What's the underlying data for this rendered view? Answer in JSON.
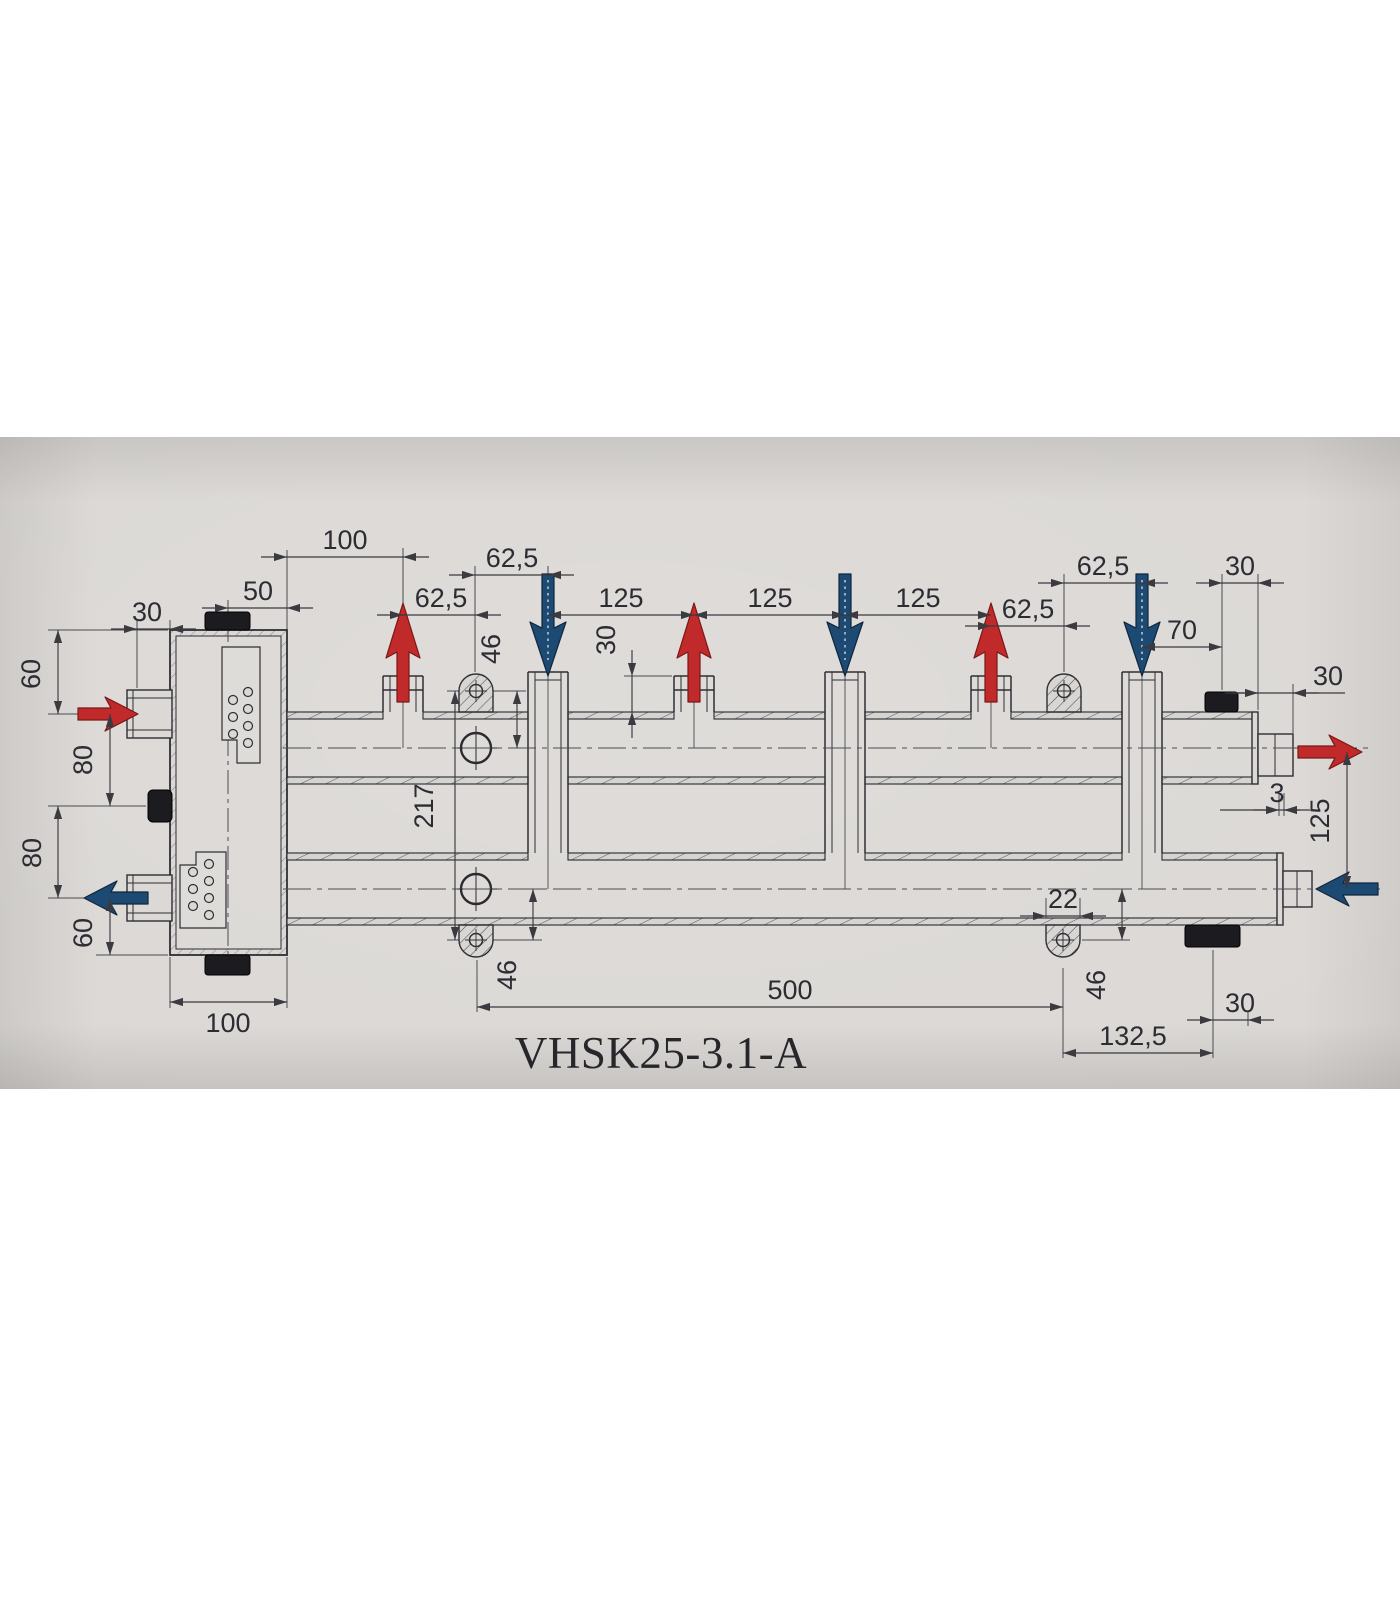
{
  "drawing": {
    "title": "VHSK25-3.1-A",
    "type": "hydraulic-manifold-dimension-drawing",
    "colors": {
      "paper": "#dbd8d5",
      "line": "#2e2e34",
      "supply_arrow": "#c02a2a",
      "return_arrow": "#1d4a73"
    },
    "labels": {
      "top_100": "100",
      "top_62_1": "62,5",
      "top_62_2": "62,5",
      "top_125_1": "125",
      "top_125_2": "125",
      "top_125_3": "125",
      "top_62_3": "62,5",
      "top_62_4": "62,5",
      "top_30": "30",
      "top_70": "70",
      "right_30": "30",
      "right_3": "3",
      "right_125": "125",
      "left_30": "30",
      "left_50": "50",
      "left_60_top": "60",
      "left_80_top": "80",
      "left_80_bottom": "80",
      "left_60_bottom": "60",
      "left_100": "100",
      "mid_46_top": "46",
      "mid_30_stub": "30",
      "mid_217": "217",
      "mid_46_left": "46",
      "mid_22": "22",
      "mid_46_right": "46",
      "bottom_500": "500",
      "bottom_132": "132,5",
      "bottom_30": "30",
      "title": "VHSK25-3.1-A"
    },
    "flow_arrows": [
      {
        "name": "supply-inlet-left",
        "direction": "right",
        "type": "supply"
      },
      {
        "name": "return-outlet-left",
        "direction": "left",
        "type": "return"
      },
      {
        "name": "supply-outlet-circuit-1",
        "direction": "up",
        "type": "supply"
      },
      {
        "name": "return-inlet-circuit-1",
        "direction": "down",
        "type": "return"
      },
      {
        "name": "supply-outlet-circuit-2",
        "direction": "up",
        "type": "supply"
      },
      {
        "name": "return-inlet-circuit-2",
        "direction": "down",
        "type": "return"
      },
      {
        "name": "supply-outlet-circuit-3",
        "direction": "up",
        "type": "supply"
      },
      {
        "name": "return-inlet-circuit-3",
        "direction": "down",
        "type": "return"
      },
      {
        "name": "supply-outlet-right",
        "direction": "right",
        "type": "supply"
      },
      {
        "name": "return-inlet-right",
        "direction": "left",
        "type": "return"
      }
    ]
  }
}
